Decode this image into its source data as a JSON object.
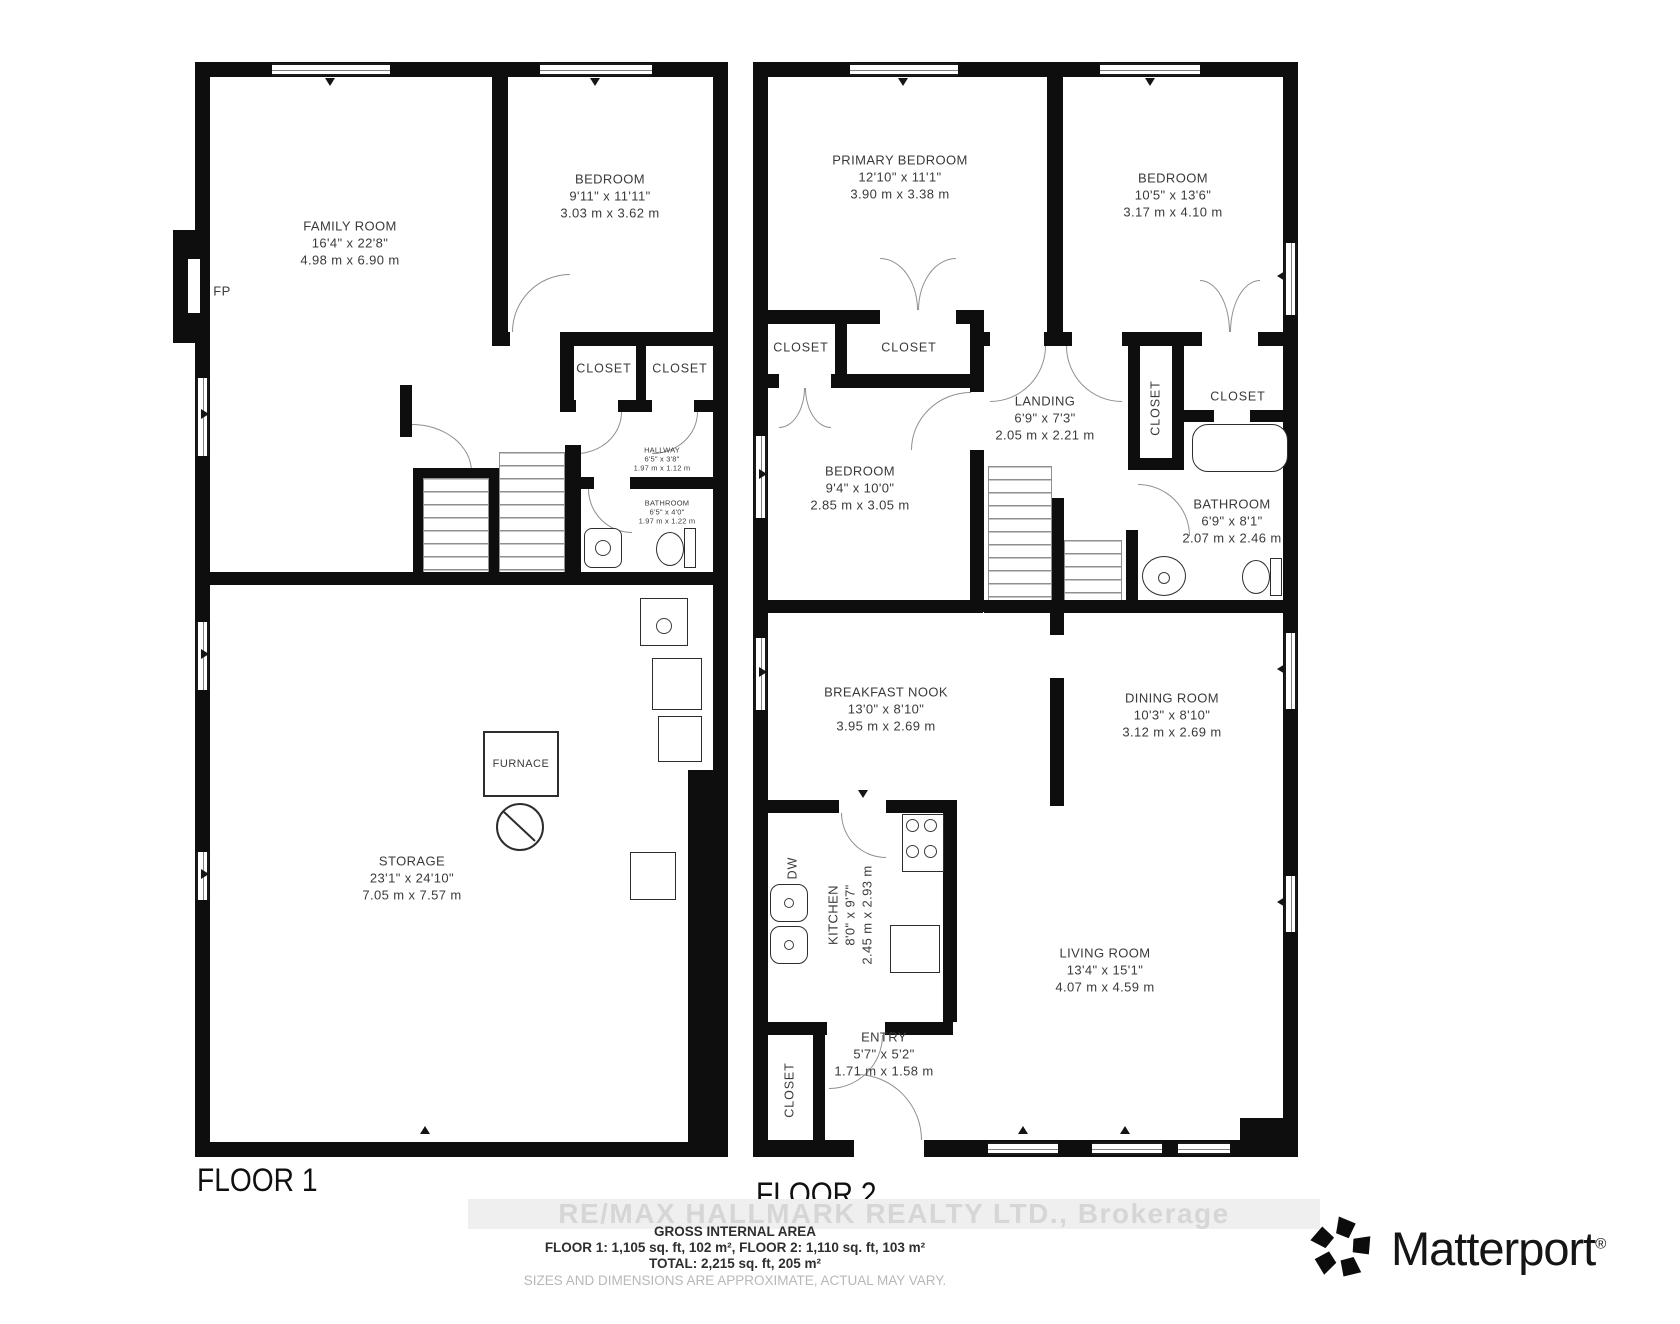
{
  "floor1": {
    "label": "FLOOR 1",
    "family_room": {
      "name": "FAMILY ROOM",
      "imperial": "16'4\" x 22'8\"",
      "metric": "4.98 m x 6.90 m"
    },
    "bedroom": {
      "name": "BEDROOM",
      "imperial": "9'11\" x 11'11\"",
      "metric": "3.03 m x 3.62 m"
    },
    "closet_a": {
      "name": "CLOSET"
    },
    "closet_b": {
      "name": "CLOSET"
    },
    "hallway": {
      "name": "HALLWAY",
      "imperial": "6'5\" x 3'8\"",
      "metric": "1.97 m x 1.12 m"
    },
    "bathroom": {
      "name": "BATHROOM",
      "imperial": "6'5\" x 4'0\"",
      "metric": "1.97 m x 1.22 m"
    },
    "storage": {
      "name": "STORAGE",
      "imperial": "23'1\" x 24'10\"",
      "metric": "7.05 m x 7.57 m"
    },
    "furnace_label": "FURNACE",
    "fireplace_label": "FP"
  },
  "floor2": {
    "label": "FLOOR 2",
    "primary_bedroom": {
      "name": "PRIMARY BEDROOM",
      "imperial": "12'10\" x 11'1\"",
      "metric": "3.90 m x 3.38 m"
    },
    "bedroom_right": {
      "name": "BEDROOM",
      "imperial": "10'5\" x 13'6\"",
      "metric": "3.17 m x 4.10 m"
    },
    "bedroom_mid": {
      "name": "BEDROOM",
      "imperial": "9'4\" x 10'0\"",
      "metric": "2.85 m x 3.05 m"
    },
    "landing": {
      "name": "LANDING",
      "imperial": "6'9\" x 7'3\"",
      "metric": "2.05 m x 2.21 m"
    },
    "bathroom": {
      "name": "BATHROOM",
      "imperial": "6'9\" x 8'1\"",
      "metric": "2.07 m x 2.46 m"
    },
    "breakfast_nook": {
      "name": "BREAKFAST NOOK",
      "imperial": "13'0\" x 8'10\"",
      "metric": "3.95 m x 2.69 m"
    },
    "dining_room": {
      "name": "DINING ROOM",
      "imperial": "10'3\" x 8'10\"",
      "metric": "3.12 m x 2.69 m"
    },
    "kitchen": {
      "name": "KITCHEN",
      "imperial": "8'0\" x 9'7\"",
      "metric": "2.45 m x 2.93 m"
    },
    "living_room": {
      "name": "LIVING ROOM",
      "imperial": "13'4\" x 15'1\"",
      "metric": "4.07 m x 4.59 m"
    },
    "entry": {
      "name": "ENTRY",
      "imperial": "5'7\" x 5'2\"",
      "metric": "1.71 m x 1.58 m"
    },
    "closet_left": {
      "name": "CLOSET"
    },
    "closet_mid": {
      "name": "CLOSET"
    },
    "closet_landing": {
      "name": "CLOSET"
    },
    "closet_bath": {
      "name": "CLOSET"
    },
    "closet_entry": {
      "name": "CLOSET"
    },
    "dishwasher_label": "DW"
  },
  "footer": {
    "watermark": "RE/MAX HALLMARK REALTY LTD., Brokerage",
    "area_title": "GROSS INTERNAL AREA",
    "area_line1": "FLOOR 1: 1,105 sq. ft, 102 m², FLOOR 2: 1,110 sq. ft, 103 m²",
    "area_line2": "TOTAL: 2,215 sq. ft, 205 m²",
    "disclaimer": "SIZES AND DIMENSIONS ARE APPROXIMATE, ACTUAL MAY VARY.",
    "brand": "Matterport",
    "brand_mark": "®"
  }
}
